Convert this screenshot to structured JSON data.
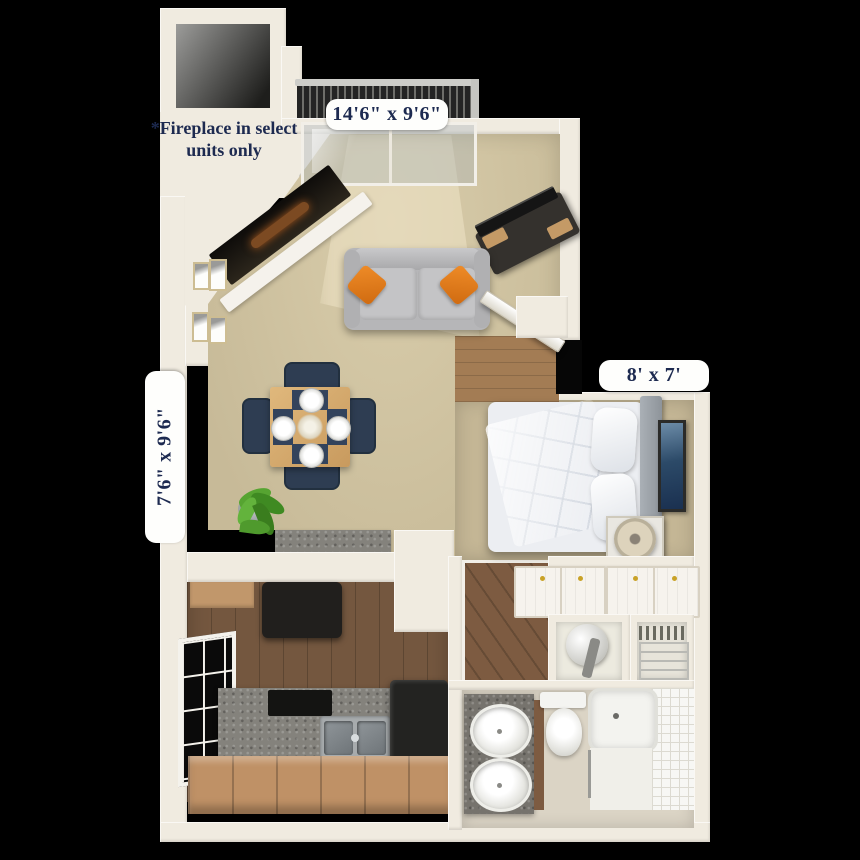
{
  "floor_plan": {
    "dimension_labels": [
      {
        "room": "living-room-balcony",
        "text": "14'6\" x 9'6\""
      },
      {
        "room": "dining-area",
        "text": "7'6\" x 9'6\""
      },
      {
        "room": "bedroom",
        "text": "8' x 7'"
      }
    ],
    "fireplace_note": "*Fireplace in select units only",
    "colors": {
      "background": "#000000",
      "wall": "#f0ebe0",
      "label_text": "#1d2a50",
      "label_pill": "#fefefc",
      "living_carpet": "#ccbf9e",
      "bedroom_carpet": "#c4b695",
      "kitchen_floor": "#6f5139",
      "entry_floor": "#a37c54",
      "bathroom_floor": "#dbd4c5",
      "sofa": "#b6b6b8",
      "accent_pillow": "#e0761c",
      "dining_chair": "#2e3d52",
      "table_wood": "#d8ad72",
      "plant": "#4f9a2d",
      "appliance_black": "#232321",
      "granite": "#84827c"
    }
  }
}
